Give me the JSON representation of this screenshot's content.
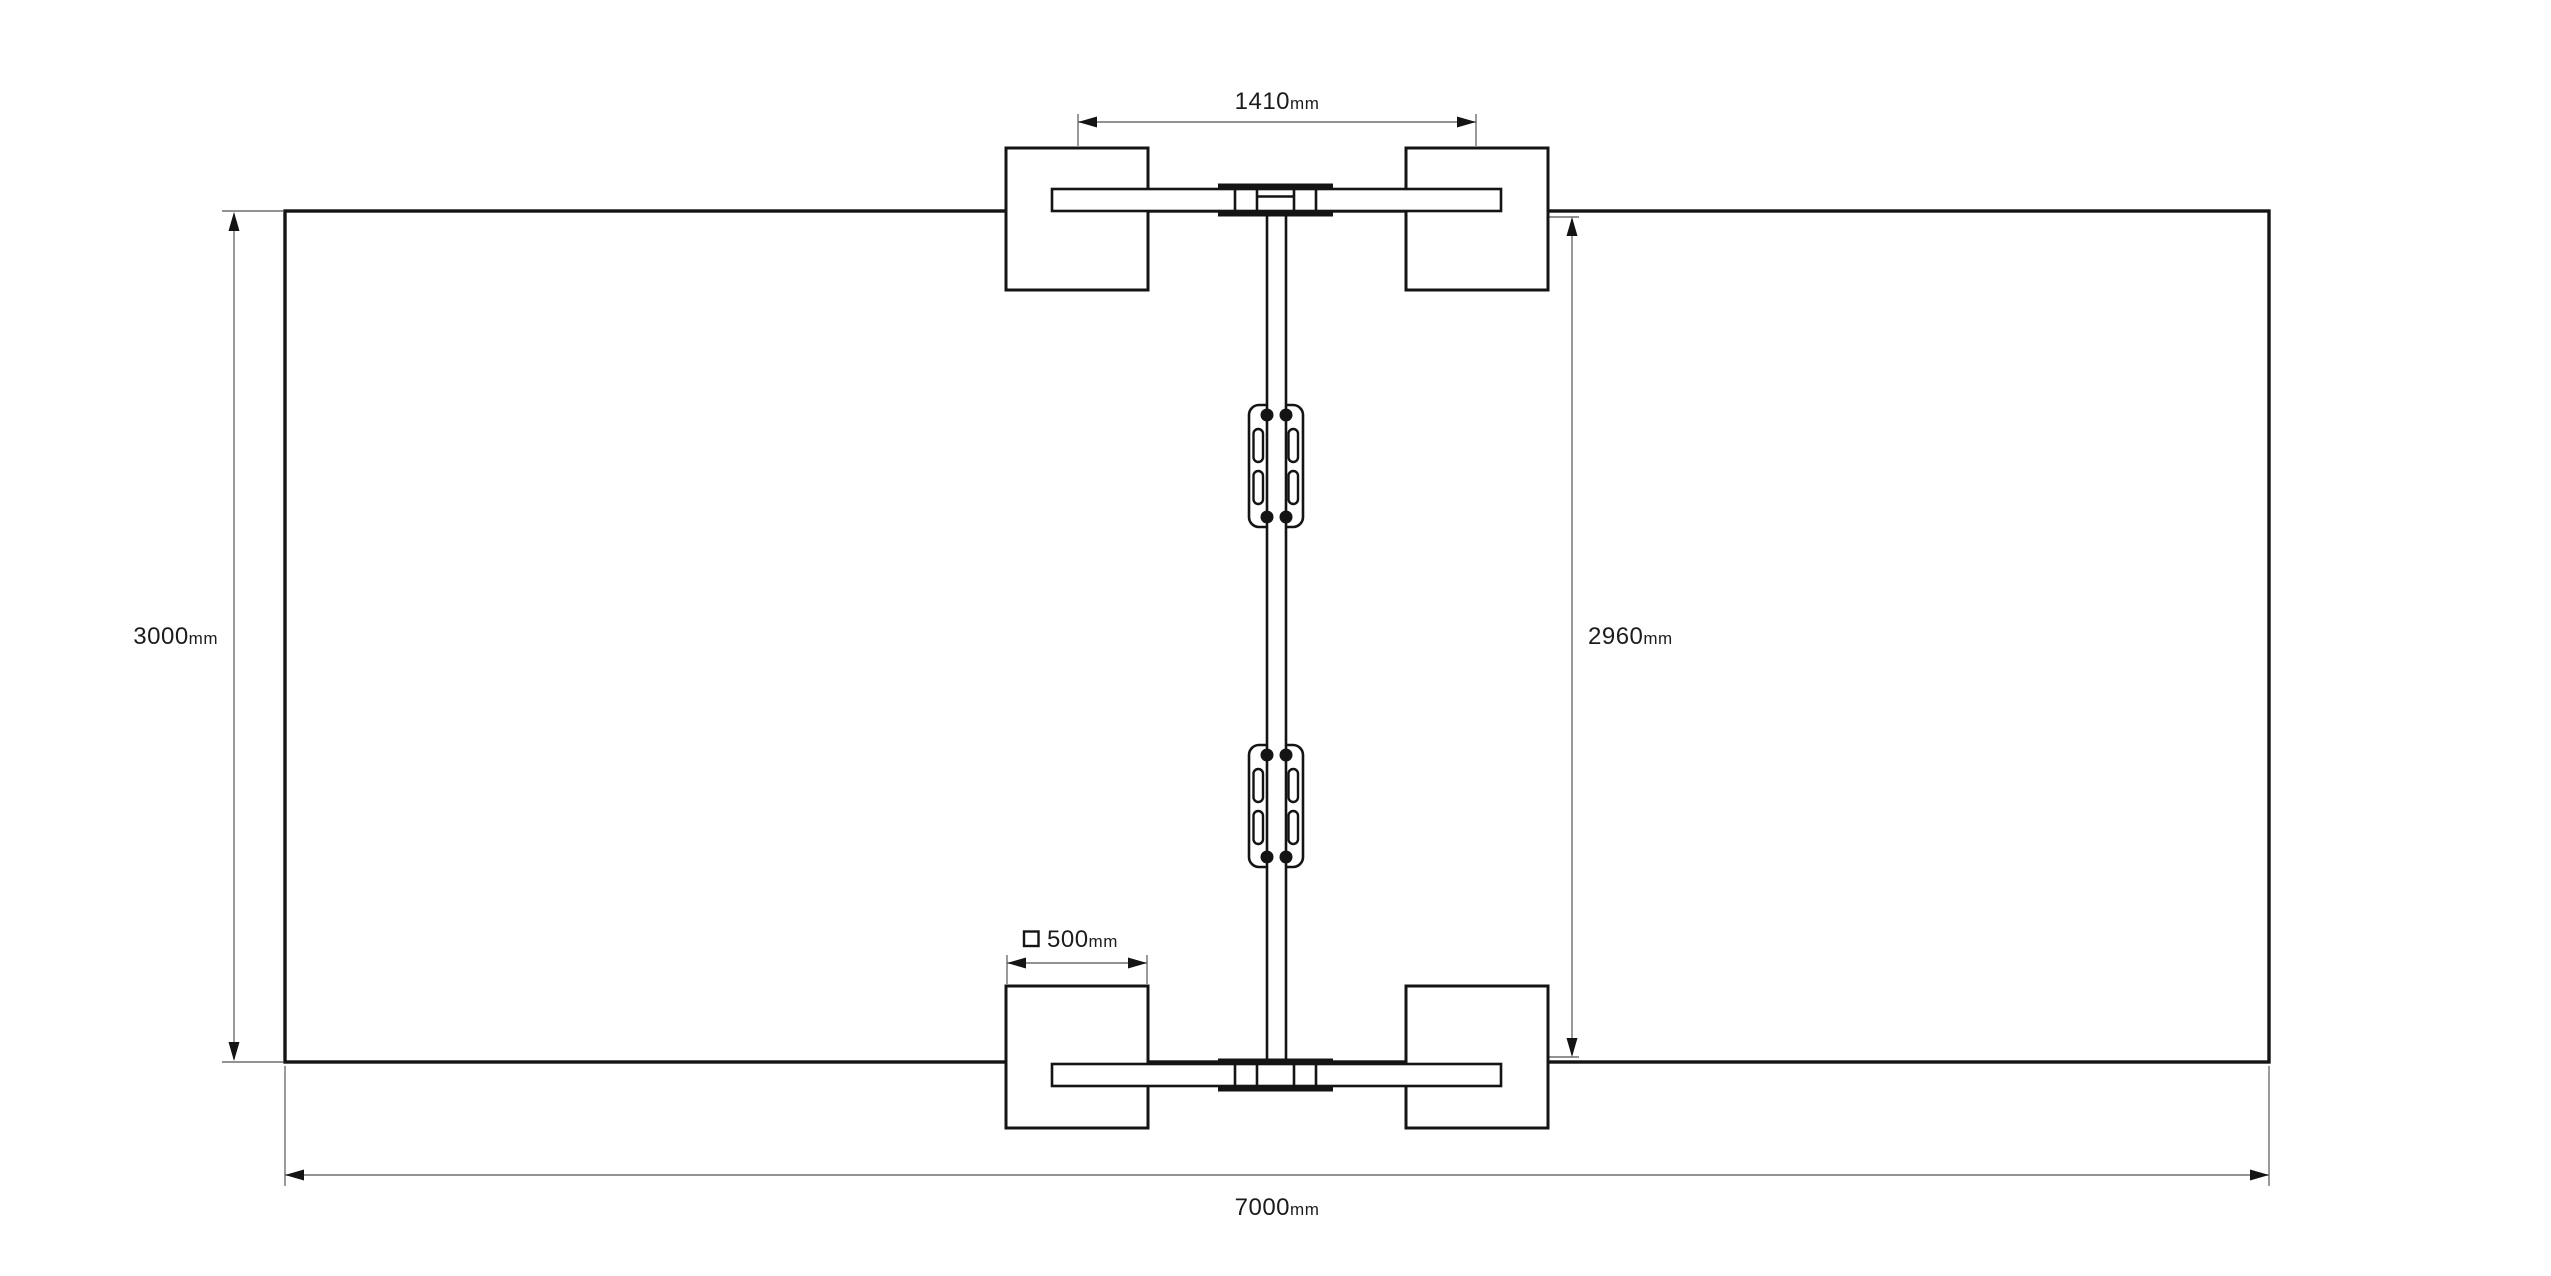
{
  "drawing": {
    "background_color": "#ffffff",
    "line_color": "#141414",
    "dimension_line_color": "#6e6e6e",
    "dimensions": {
      "top_width": {
        "value": "1410",
        "unit": "mm"
      },
      "left_height": {
        "value": "3000",
        "unit": "mm"
      },
      "right_height": {
        "value": "2960",
        "unit": "mm"
      },
      "pad_width": {
        "value": "500",
        "unit": "mm",
        "prefix_icon": "square-symbol"
      },
      "bottom_width": {
        "value": "7000",
        "unit": "mm"
      }
    }
  }
}
